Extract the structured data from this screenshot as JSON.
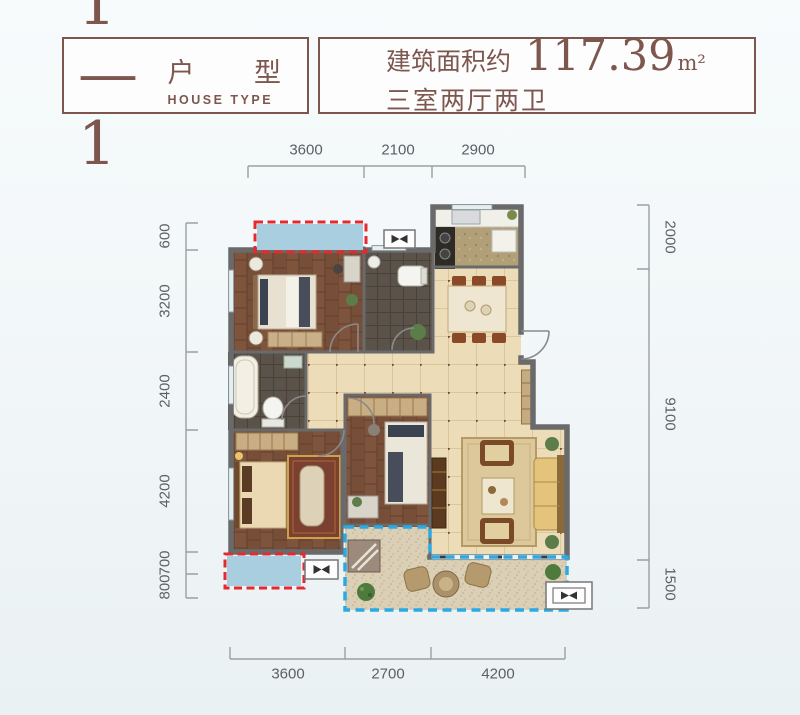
{
  "header": {
    "left": {
      "number": "1—1",
      "label": "户 型",
      "sublabel": "HOUSE TYPE"
    },
    "right": {
      "prefix": "建筑面积约",
      "area": "117.39",
      "unit": "m²",
      "rooms": "三室两厅两卫"
    }
  },
  "dimensions": {
    "top": [
      "3600",
      "2100",
      "2900"
    ],
    "bottom": [
      "3600",
      "2700",
      "4200"
    ],
    "left": [
      "600",
      "3200",
      "2400",
      "4200",
      "700",
      "800"
    ],
    "right": [
      "2000",
      "9100",
      "1500"
    ]
  },
  "colors": {
    "brand_brown": "#7d564e",
    "dimension_gray": "#5d6063",
    "red_dashed": "#e42a2e",
    "blue_dashed": "#2ba9e2",
    "bay_window_fill": "#a9cee0",
    "wood_floor": "#7f543d",
    "tile_floor": "#ecdcb8",
    "dark_tile": "#5b534a",
    "sand_floor": "#dbcfb5",
    "wall": "#6a6a6a"
  }
}
